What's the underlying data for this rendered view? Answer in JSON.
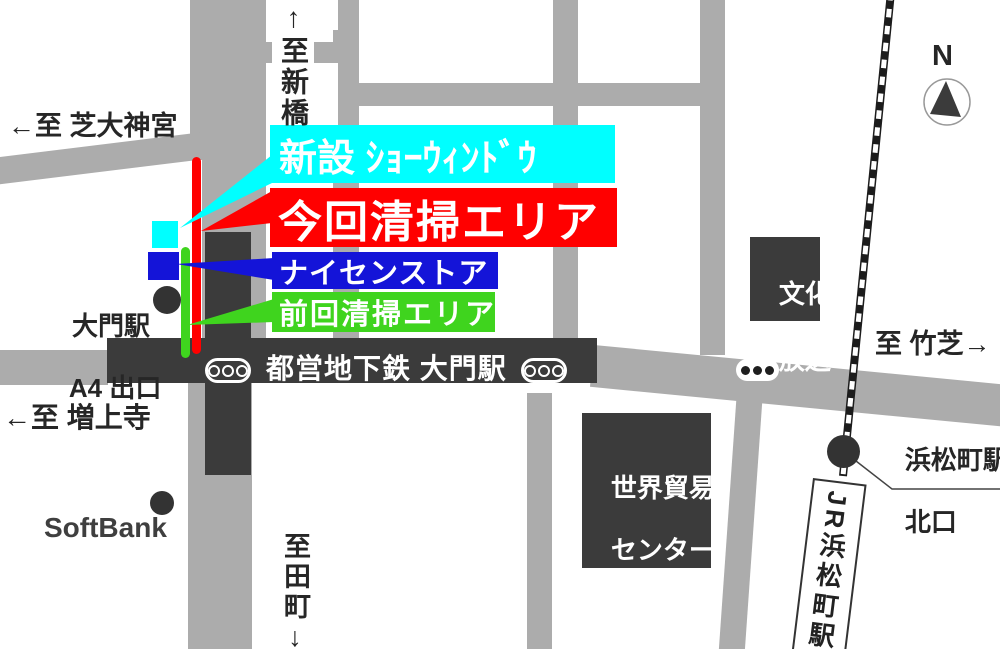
{
  "colors": {
    "road": "#acacac",
    "dark": "#3b3b3b",
    "cyan": "#00ffff",
    "red": "#ff0000",
    "blue": "#1414d8",
    "green": "#3fd41e"
  },
  "compass_n": "N",
  "legend": {
    "new_window": {
      "label": "新設 ｼｮｰｳｨﾝﾄﾞｳ",
      "color": "#00ffff"
    },
    "current_area": {
      "label": "今回清掃エリア",
      "color": "#ff0000"
    },
    "store": {
      "label": "ナイセンストア",
      "color": "#1414d8"
    },
    "previous_area": {
      "label": "前回清掃エリア",
      "color": "#3fd41e"
    }
  },
  "directions": {
    "shinbashi": "↑至新橋",
    "shiba": "←至 芝大神宮",
    "zojoji": "←至 増上寺",
    "takeshiba": "至 竹芝→",
    "tamachi": "至田町↓"
  },
  "subway_bar": "都営地下鉄 大門駅",
  "daimon_exit": {
    "line1": "大門駅",
    "line2": "A4 出口"
  },
  "softbank": "SoftBank",
  "bunka": {
    "line1": "文化",
    "line2": "放送"
  },
  "wtc": {
    "line1": "世界貿易",
    "line2": "センター",
    "line3": "ビル"
  },
  "hamamatsucho": {
    "line1": "浜松町駅",
    "line2": "北口"
  },
  "jr_station": "JR浜松町駅"
}
